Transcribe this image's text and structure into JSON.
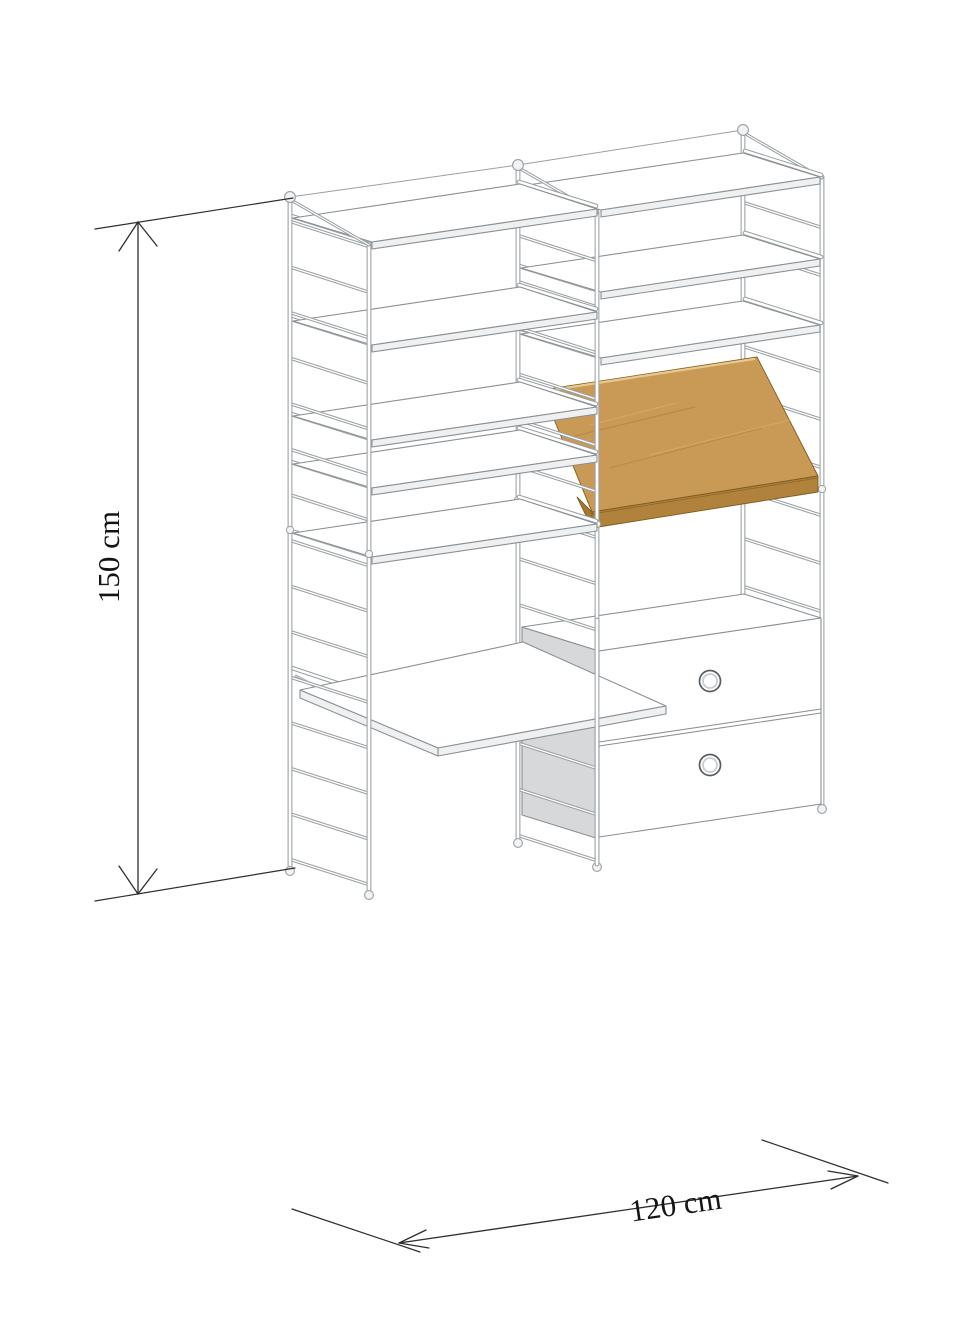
{
  "diagram": {
    "subject": "wall-mounted shelving unit with ladder side panels, shelves, angled magazine shelf, desk surface and two-drawer cabinet",
    "view": "isometric technical line drawing"
  },
  "dimensions": {
    "height_label": "150 cm",
    "width_label": "120 cm"
  },
  "colors": {
    "background": "#ffffff",
    "outline": "#9aa0a3",
    "shelf_outline": "#8a9094",
    "panel_fill": "#ffffff",
    "shelf_edge_fill": "#eef0f1",
    "cabinet_side": "#d6d8da",
    "wood_face": "#c89a55",
    "wood_lip": "#b0823c",
    "wood_end": "#a5782f",
    "wood_edge_highlight": "#e8c98c",
    "wood_outline": "#7d5c22",
    "dimension_line": "#2e2e2e",
    "dimension_text": "#141414"
  },
  "components": [
    "left wall panel",
    "middle wall panel",
    "right wall panel",
    "shelf",
    "magazine shelf",
    "desk",
    "two-drawer cabinet",
    "drawer knob"
  ]
}
